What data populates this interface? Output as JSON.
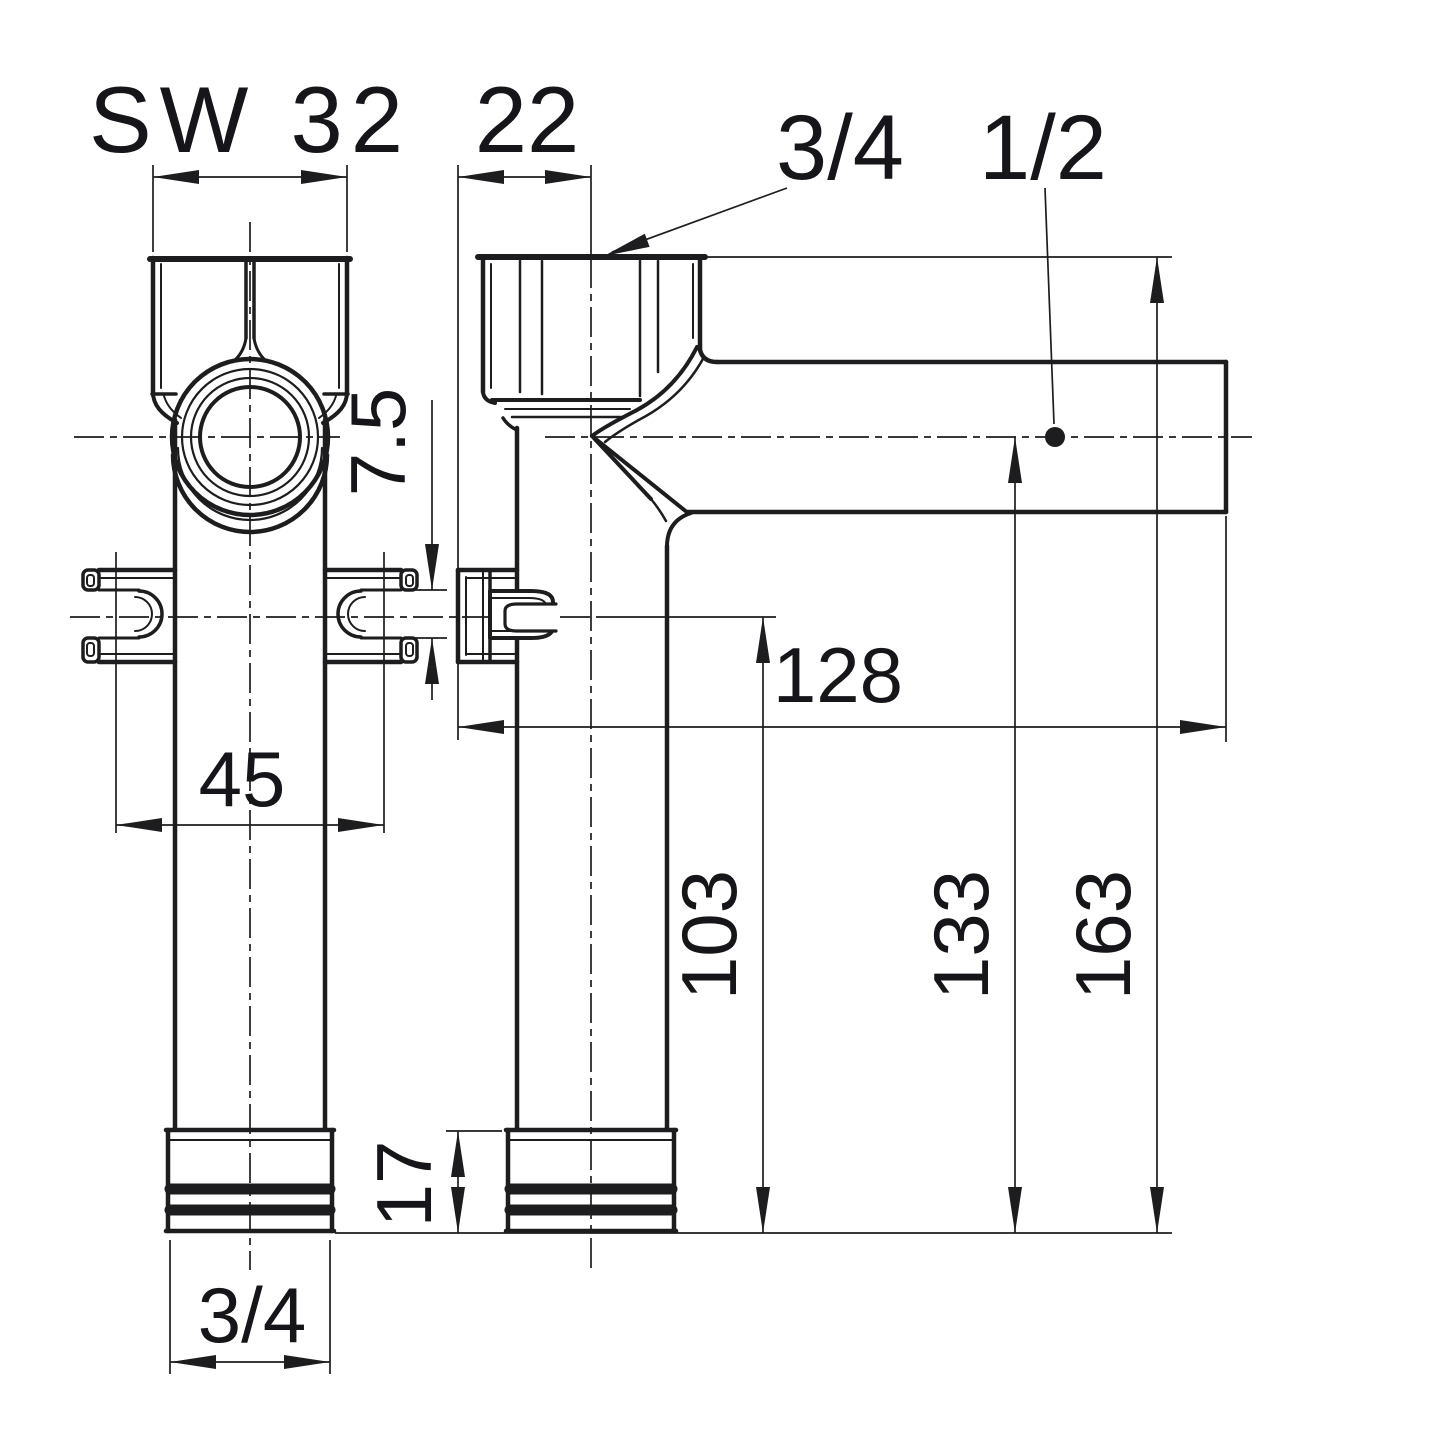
{
  "drawing": {
    "type": "technical-dimension-drawing",
    "views": [
      "side-view",
      "front-view"
    ],
    "colors": {
      "line": "#1d1d1f",
      "background": "#ffffff"
    },
    "labels": {
      "wrench_size": "SW 32",
      "wall_offset": "22",
      "top_thread": "3/4",
      "branch_thread": "1/2",
      "slot_width": "7.5",
      "arm_reach": "128",
      "screw_spacing": "45",
      "bracket_height": "103",
      "outlet_height": "133",
      "total_height": "163",
      "union_nut_height": "17",
      "bottom_thread": "3/4"
    }
  }
}
